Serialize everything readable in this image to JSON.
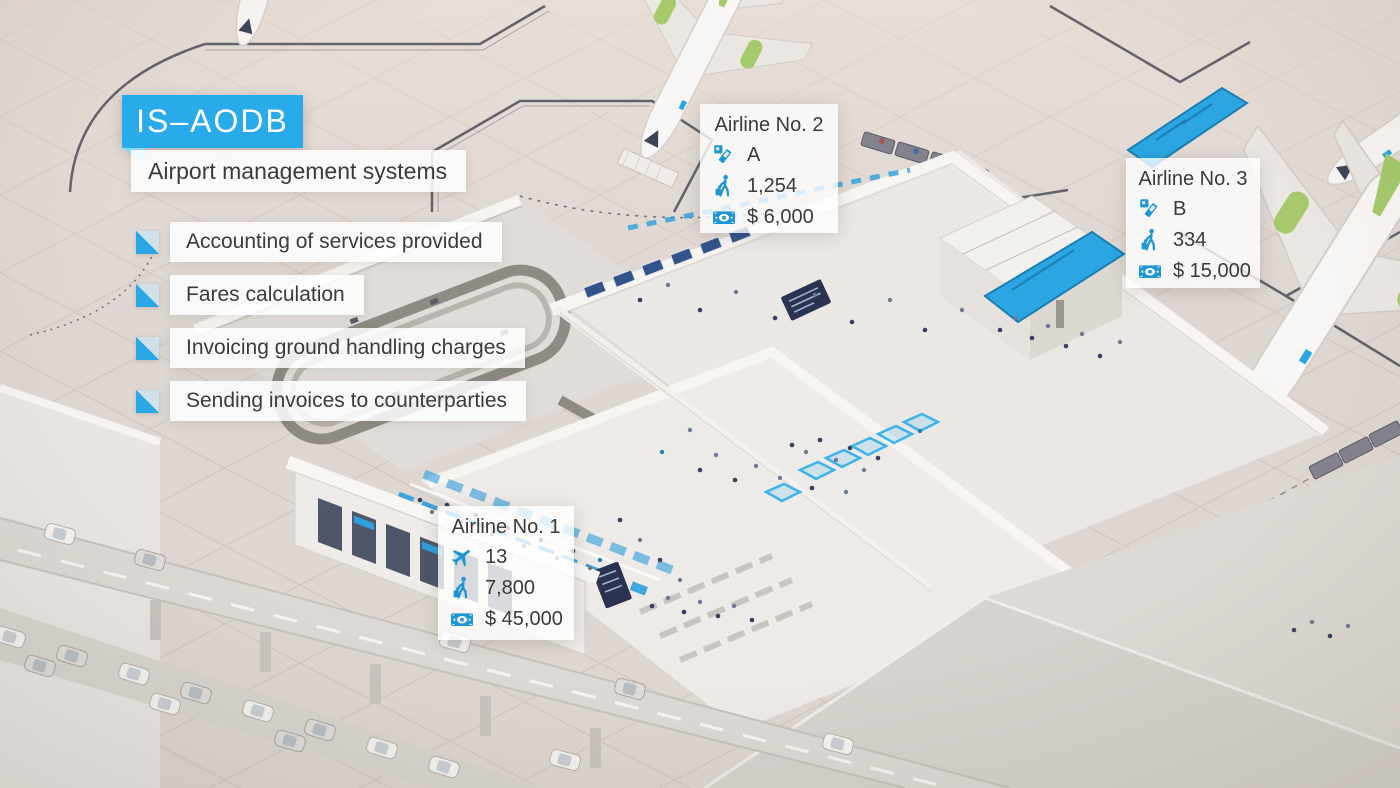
{
  "header": {
    "title": "IS–AODB",
    "subtitle": "Airport management systems"
  },
  "features": [
    {
      "label": "Accounting of services provided"
    },
    {
      "label": "Fares calculation"
    },
    {
      "label": "Invoicing ground handling charges"
    },
    {
      "label": "Sending invoices to counterparties"
    }
  ],
  "cards": [
    {
      "id": "airline-1",
      "title": "Airline No. 1",
      "rows": [
        {
          "icon": "airplane-icon",
          "value": "13"
        },
        {
          "icon": "passenger-icon",
          "value": "7,800"
        },
        {
          "icon": "money-icon",
          "value": "$ 45,000"
        }
      ]
    },
    {
      "id": "airline-2",
      "title": "Airline No. 2",
      "rows": [
        {
          "icon": "boarding-pass-icon",
          "value": "A"
        },
        {
          "icon": "passenger-icon",
          "value": "1,254"
        },
        {
          "icon": "money-icon",
          "value": "$ 6,000"
        }
      ]
    },
    {
      "id": "airline-3",
      "title": "Airline No. 3",
      "rows": [
        {
          "icon": "boarding-pass-icon",
          "value": "B"
        },
        {
          "icon": "passenger-icon",
          "value": "334"
        },
        {
          "icon": "money-icon",
          "value": "$ 15,000"
        }
      ]
    }
  ],
  "colors": {
    "accent": "#29abe9",
    "accent_light": "#8ed9f8",
    "icon_blue": "#1f96d4",
    "text_dark": "#3b3b3b",
    "scene_base": "#ddd6d1",
    "plane_green": "#a5c96b",
    "taxiway_line": "#4d4d58"
  }
}
